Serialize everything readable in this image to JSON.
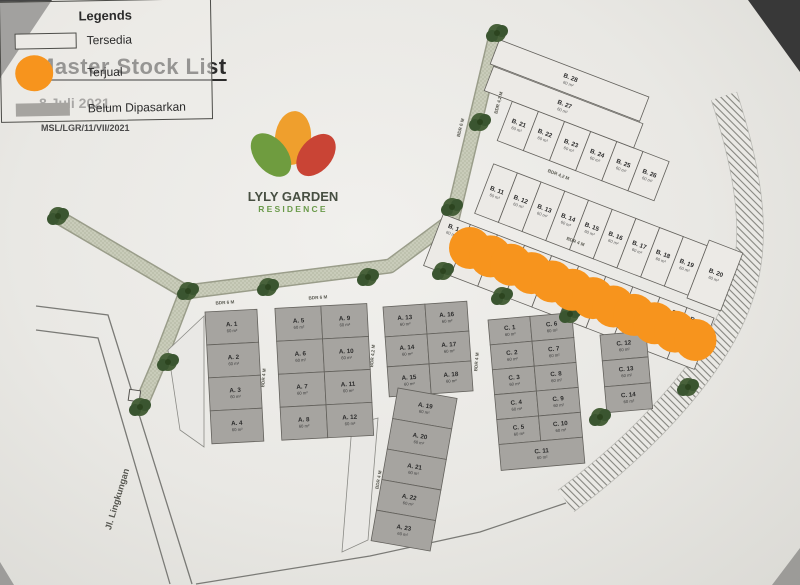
{
  "header": {
    "title": "Master Stock List",
    "date": "8 Juli 2021",
    "ref": "MSL/LGR/11/VII/2021"
  },
  "logo": {
    "line1": "LYLY GARDEN",
    "line2": "RESIDENCE"
  },
  "legend": {
    "title": "Legends",
    "items": [
      {
        "key": "available",
        "label": "Tersedia"
      },
      {
        "key": "sold",
        "label": "Terjual"
      },
      {
        "key": "unmarketed",
        "label": "Belum Dipasarkan"
      }
    ]
  },
  "colors": {
    "sold": "#f7941d",
    "unmarketed": "#a6a4a0",
    "available": "#eceae6",
    "plot_stroke": "#63615c",
    "road_fill": "#c9ccba",
    "road_edge": "#9a9d8a",
    "tree_green": "#48613a",
    "petal_green": "#6f9c3f",
    "petal_orange": "#ef9f2d",
    "petal_red": "#c94435"
  },
  "map": {
    "road_name": "Jl. Lingkungan",
    "area_label": "60 m²",
    "sold_marker_count": 12,
    "road_labels": [
      {
        "text": "BDR 6 M",
        "x": 462,
        "y": 128,
        "rot": -76
      },
      {
        "text": "BDR 4,2 M",
        "x": 500,
        "y": 103,
        "rot": -76
      },
      {
        "text": "BDR 6 M",
        "x": 318,
        "y": 299,
        "rot": -4
      },
      {
        "text": "BDR 6 M",
        "x": 225,
        "y": 304,
        "rot": -4
      },
      {
        "text": "BDR 4,2 M",
        "x": 558,
        "y": 176,
        "rot": 21
      },
      {
        "text": "BDR 4 M",
        "x": 575,
        "y": 243,
        "rot": 21
      },
      {
        "text": "BDR 4 M",
        "x": 652,
        "y": 322,
        "rot": 21
      },
      {
        "text": "BDR 6 M",
        "x": 540,
        "y": 293,
        "rot": -4
      },
      {
        "text": "BDR 4 M",
        "x": 380,
        "y": 480,
        "rot": -80
      },
      {
        "text": "BDR 4 M",
        "x": 265,
        "y": 378,
        "rot": -85
      },
      {
        "text": "BDR 4,2 M",
        "x": 374,
        "y": 356,
        "rot": -85
      },
      {
        "text": "BDR 4 M",
        "x": 478,
        "y": 362,
        "rot": -85
      }
    ],
    "plots": {
      "b": [
        "B. 1",
        "B. 2",
        "B. 3",
        "B. 4",
        "B. 5",
        "B. 6",
        "B. 7",
        "B. 8",
        "B. 9",
        "B. 10",
        "B. 11",
        "B. 12",
        "B. 13",
        "B. 14",
        "B. 15",
        "B. 16",
        "B. 17",
        "B. 18",
        "B. 19",
        "B. 20",
        "B. 21",
        "B. 22",
        "B. 23",
        "B. 24",
        "B. 25",
        "B. 26",
        "B. 27",
        "B. 28"
      ],
      "a": [
        "A. 1",
        "A. 2",
        "A. 3",
        "A. 4",
        "A. 5",
        "A. 6",
        "A. 7",
        "A. 8",
        "A. 9",
        "A. 10",
        "A. 11",
        "A. 12",
        "A. 13",
        "A. 14",
        "A. 15",
        "A. 16",
        "A. 17",
        "A. 18",
        "A. 19",
        "A. 20",
        "A. 21",
        "A. 22",
        "A. 23"
      ],
      "c": [
        "C. 1",
        "C. 2",
        "C. 3",
        "C. 4",
        "C. 5",
        "C. 6",
        "C. 7",
        "C. 8",
        "C. 9",
        "C. 10",
        "C. 11",
        "C. 12",
        "C. 13",
        "C. 14"
      ]
    },
    "sold_plot_labels": [
      "B. 1",
      "B. 2",
      "B. 3",
      "B. 4",
      "B. 5",
      "B. 6",
      "B. 7",
      "B. 8",
      "B. 9",
      "B. 10"
    ]
  }
}
